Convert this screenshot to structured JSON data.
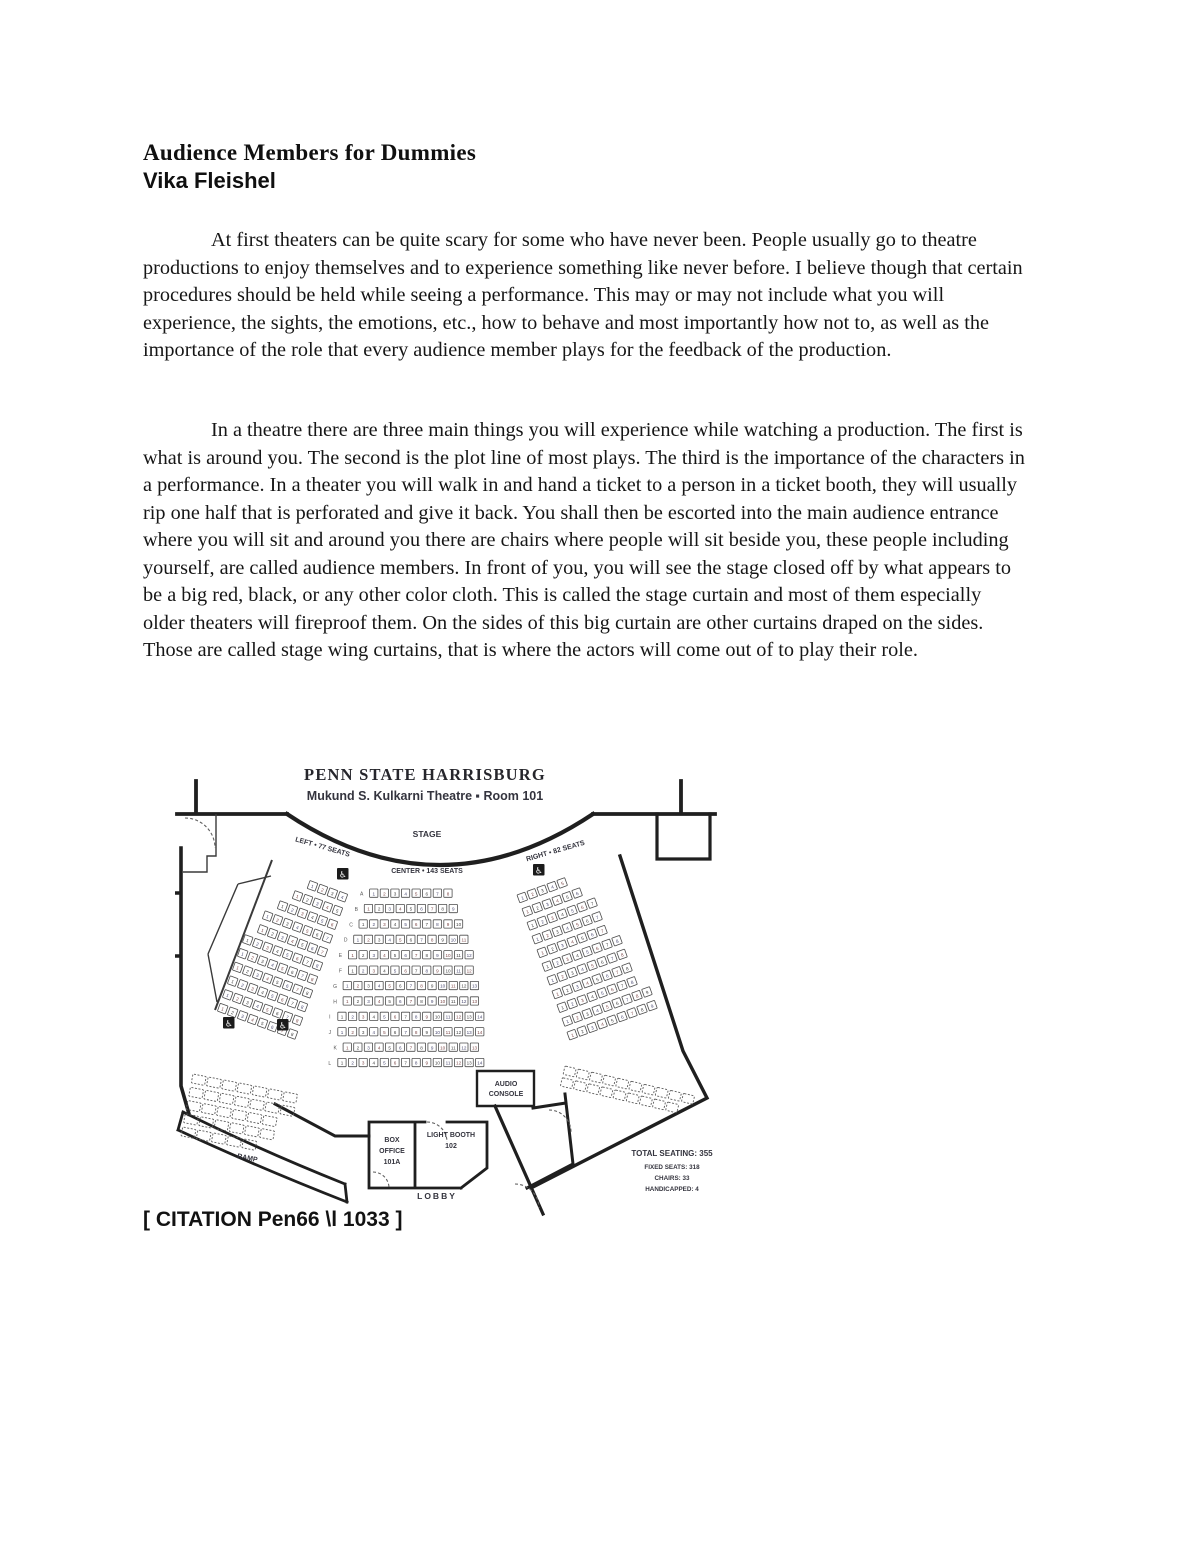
{
  "document": {
    "title": "Audience Members for Dummies",
    "author": "Vika Fleishel",
    "paragraphs": [
      "At first theaters can be quite scary for some who have never been. People usually go to theatre productions to enjoy themselves and to experience something like never before. I believe though that certain procedures should be held while seeing a performance. This may or may not include what you will experience, the sights, the emotions, etc., how to behave and most importantly how not to, as well as the importance of the role that every audience member plays for the feedback of the production.",
      "In a theatre there are three main things you will experience while watching a production. The first is what is around you. The second is the plot line of most plays. The third is the importance of the characters in a performance. In a theater you will walk in and hand a ticket to a person in a ticket booth, they will usually rip one half that is perforated and give it back. You shall then be escorted into the main audience entrance where you will sit and around you there are chairs where people will sit beside you, these people including yourself, are called audience members. In front of you, you will see the stage closed off by what appears to be a big red, black, or any other color cloth. This is called the stage curtain and most of them especially older theaters will fireproof them. On the sides of this big curtain are other curtains draped on the sides. Those are called stage wing curtains, that is where the actors will come out of to play their role."
    ],
    "citation": "[ CITATION Pen66 \\l 1033 ]"
  },
  "figure": {
    "title": "PENN STATE HARRISBURG",
    "subtitle": "Mukund S. Kulkarni Theatre ▪ Room 101",
    "stage_label": "STAGE",
    "sections": {
      "left": {
        "label": "LEFT • 77 SEATS",
        "seats": 77,
        "rows": [
          4,
          5,
          6,
          7,
          7,
          8,
          8,
          8,
          8,
          8,
          8
        ]
      },
      "center": {
        "label": "CENTER • 143 SEATS",
        "seats": 143,
        "rows": [
          8,
          9,
          10,
          11,
          12,
          12,
          13,
          13,
          14,
          14,
          13,
          14
        ],
        "row_letters": [
          "A",
          "B",
          "C",
          "D",
          "E",
          "F",
          "G",
          "H",
          "I",
          "J",
          "K",
          "L"
        ]
      },
      "right": {
        "label": "RIGHT • 82 SEATS",
        "seats": 82,
        "rows": [
          5,
          6,
          7,
          7,
          7,
          8,
          8,
          8,
          8,
          9,
          9
        ]
      }
    },
    "chair_rows_left": [
      7,
      7,
      6,
      6,
      5
    ],
    "chair_rows_right": [
      10,
      9
    ],
    "rooms": {
      "audio_console": [
        "AUDIO",
        "CONSOLE"
      ],
      "light_booth": [
        "LIGHT BOOTH",
        "102"
      ],
      "box_office": [
        "BOX",
        "OFFICE",
        "101A"
      ],
      "lobby": "LOBBY",
      "ramp": "RAMP"
    },
    "stats": [
      "TOTAL SEATING: 355",
      "FIXED SEATS: 318",
      "CHAIRS: 33",
      "HANDICAPPED: 4"
    ],
    "icons": {
      "wheelchair": "♿"
    }
  },
  "colors": {
    "page_bg": "#ffffff",
    "text": "#161616",
    "figure_ink": "#34343e"
  }
}
